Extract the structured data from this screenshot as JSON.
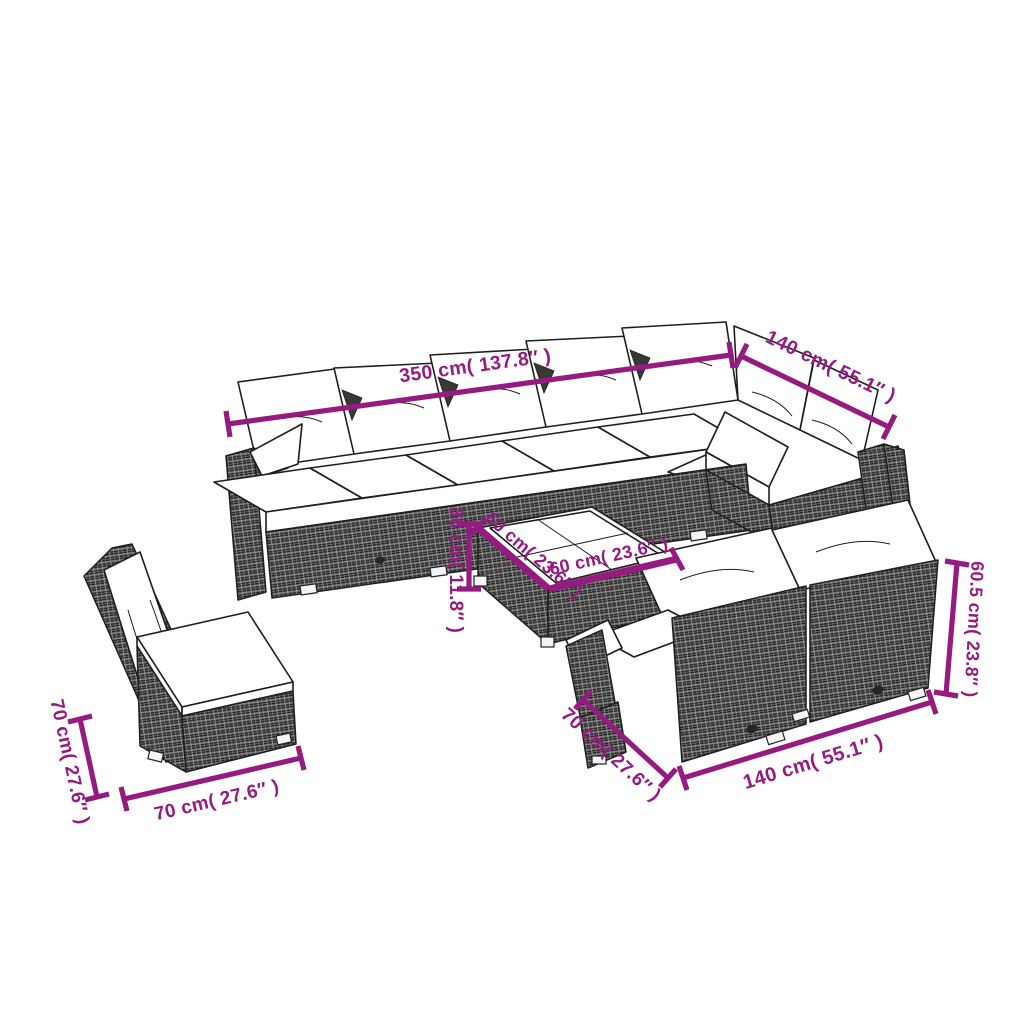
{
  "canvas": {
    "width": 1024,
    "height": 1024,
    "background": "#ffffff"
  },
  "colors": {
    "dimension_accent": "#951b81",
    "line_art": "#1e1e1e",
    "wicker_gray": "#4f4f4f",
    "cushion_white": "#ffffff"
  },
  "figure": {
    "type": "product-dimension-diagram",
    "pieces": [
      "corner-sectional-sofa",
      "coffee-table",
      "armless-chair",
      "two-seater-sofa"
    ]
  },
  "dimensions": {
    "sectional": {
      "length": "350 cm( 137.8″ )",
      "depth": "140 cm( 55.1″ )"
    },
    "coffee_table": {
      "height": "30 cm( 11.8″ )",
      "top_left_edge": "60 cm( 23.6″ )",
      "top_front_edge": "60 cm( 23.6″ )"
    },
    "armless_chair": {
      "height": "70 cm( 27.6″ )",
      "width": "70 cm( 27.6″ )"
    },
    "two_seater": {
      "depth": "70 cm( 27.6″ )",
      "length": "140 cm( 55.1″ )",
      "height": "60.5 cm( 23.8″ )"
    }
  }
}
